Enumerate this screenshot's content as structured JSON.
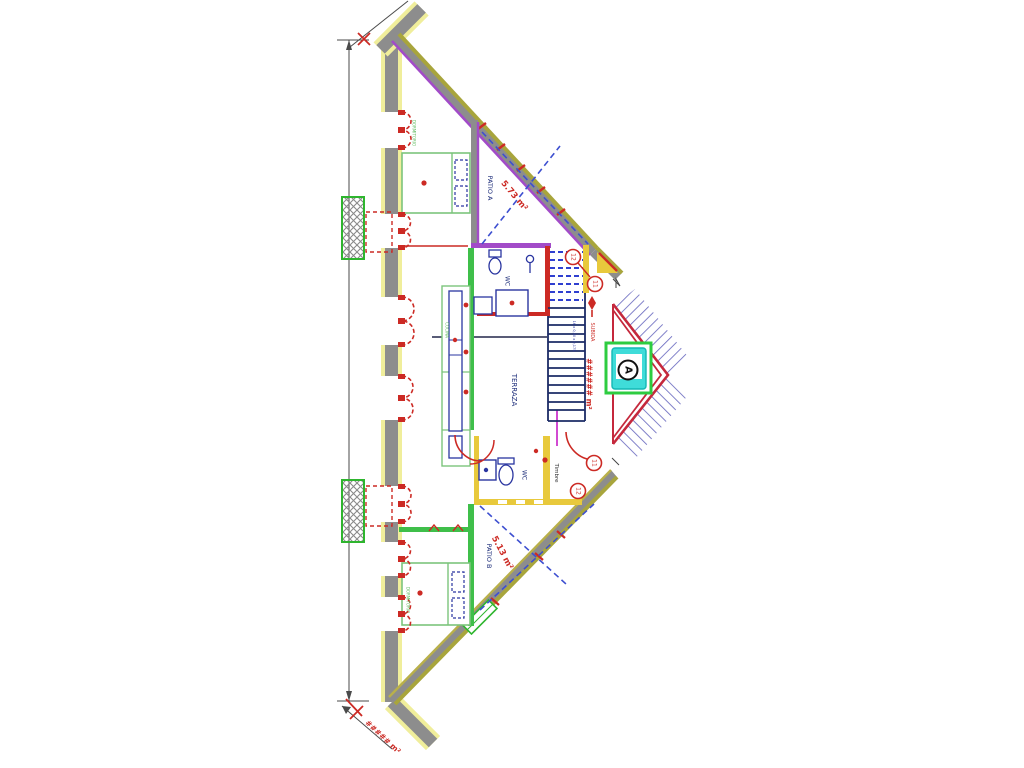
{
  "document": {
    "type": "architectural floor plan",
    "view": "triangular attic level plan"
  },
  "palette": {
    "wall_gray": "#8d8d8d",
    "wall_yellow": "#f0ee9b",
    "wall_olive": "#a8a53c",
    "wall_purple": "#a24bc8",
    "accent_red": "#cc2a24",
    "furniture_green": "#7cc47c",
    "partition_green": "#3fbf4a",
    "fixture_navy": "#2a35a0",
    "stair_blue": "#2f3fd0",
    "gold": "#e8c93c",
    "hatch_blue": "#6b6bc0",
    "elevator_cyan": "#3fdcd9",
    "elevator_green": "#2ecc40",
    "dash_blue": "#3d4fd0"
  },
  "plan": {
    "rooms": {
      "patio_a": {
        "label": "PATIO A",
        "area": "5.73 m²"
      },
      "patio_b": {
        "label": "PATIO B",
        "area": "5.13 m²"
      },
      "terrace": {
        "label": "TERRAZA"
      },
      "wc_upper": {
        "label": "WC"
      },
      "wc_lower": {
        "label": "WC"
      },
      "bedroom_upper": {
        "label": "DORMITORIO"
      },
      "bedroom_lower": {
        "label": "DORMITORIO"
      },
      "kitchen": {
        "label": "COCINA"
      }
    },
    "annotations": {
      "timbre": "Timbre",
      "stair_direction": "SUBIDA",
      "stair_spec": "16 x 0,30 x 0,175",
      "area_right": "###### m²",
      "area_bottom": "##### m²",
      "elevator_letter": "A",
      "badge_top_outer": "12",
      "badge_top_inner": "11",
      "badge_bottom_inner": "11",
      "badge_bottom_outer": "12"
    }
  }
}
